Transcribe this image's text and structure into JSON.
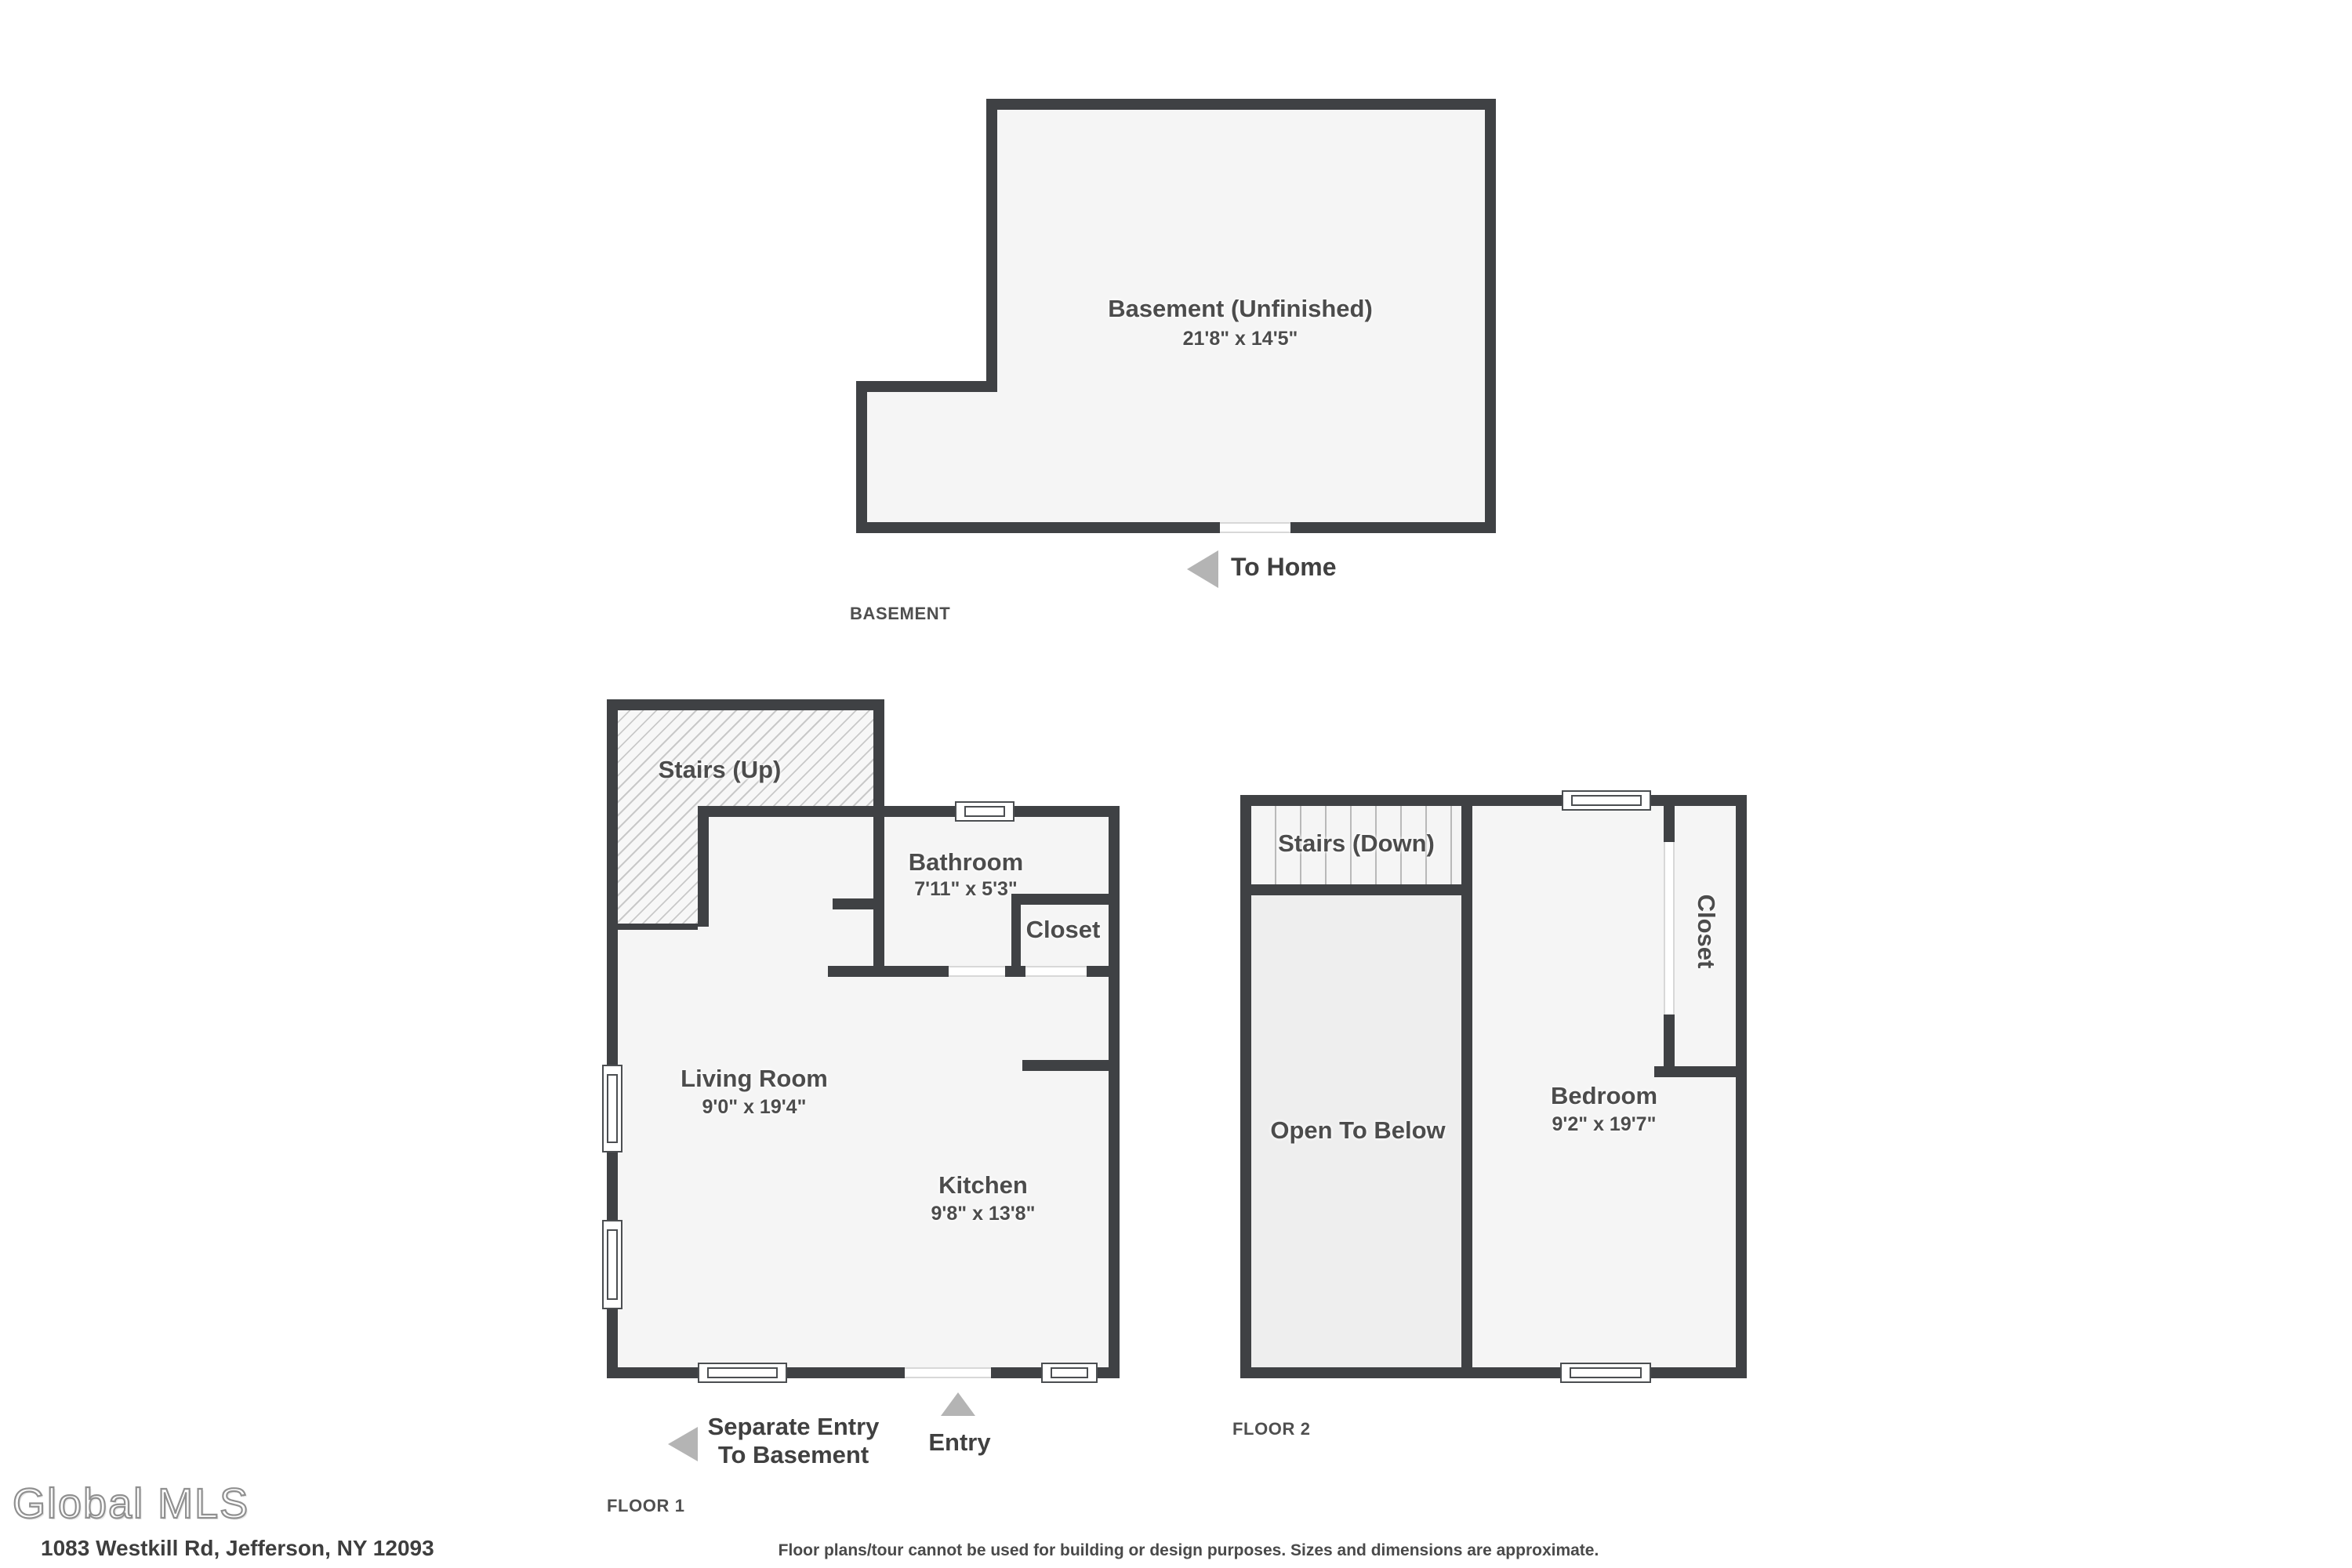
{
  "document": {
    "type": "floor-plan",
    "logo_text": "Global MLS",
    "address": "1083 Westkill Rd, Jefferson, NY 12093",
    "disclaimer": "Floor plans/tour cannot be used for building or design purposes. Sizes and dimensions are approximate."
  },
  "basement": {
    "floor_label": "BASEMENT",
    "room": {
      "name": "Basement (Unfinished)",
      "dims": "21'8\" x 14'5\""
    },
    "to_home_arrow_label": "To Home"
  },
  "floor1": {
    "floor_label": "FLOOR 1",
    "rooms": {
      "stairs_up": {
        "name": "Stairs (Up)"
      },
      "bathroom": {
        "name": "Bathroom",
        "dims": "7'11\" x 5'3\""
      },
      "closet": {
        "name": "Closet"
      },
      "living_room": {
        "name": "Living Room",
        "dims": "9'0\" x 19'4\""
      },
      "kitchen": {
        "name": "Kitchen",
        "dims": "9'8\" x 13'8\""
      }
    },
    "arrows": {
      "separate_entry_line1": "Separate Entry",
      "separate_entry_line2": "To Basement",
      "entry": "Entry"
    }
  },
  "floor2": {
    "floor_label": "FLOOR 2",
    "rooms": {
      "stairs_down": {
        "name": "Stairs (Down)"
      },
      "closet": {
        "name": "Closet"
      },
      "open_to_below": {
        "name": "Open To Below"
      },
      "bedroom": {
        "name": "Bedroom",
        "dims": "9'2\" x 19'7\""
      }
    }
  },
  "colors": {
    "wall": "#3f4144",
    "room_fill": "#f5f5f5",
    "open_area_fill": "#eeeeee",
    "arrow": "#b4b4b4",
    "label_text": "#4c4c4c"
  }
}
